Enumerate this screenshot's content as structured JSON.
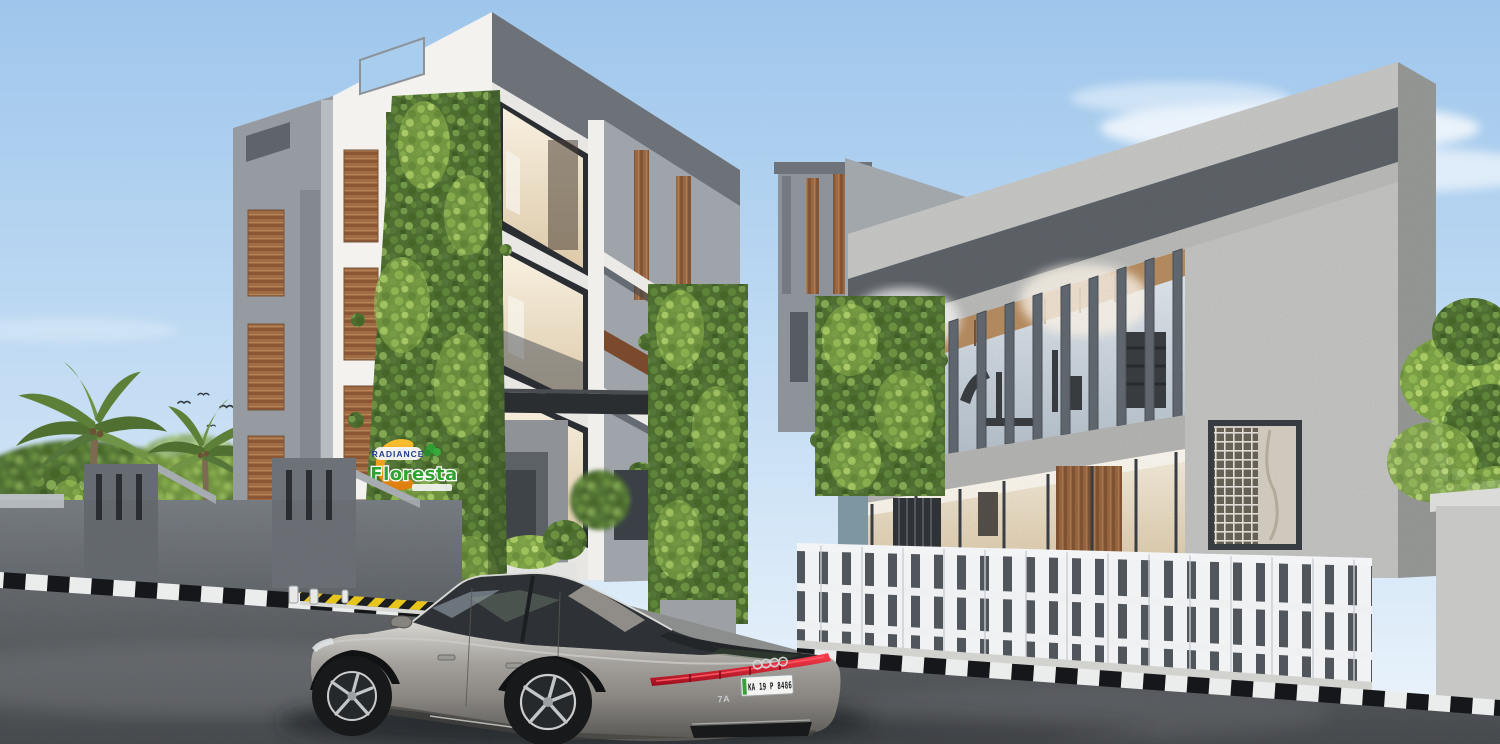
{
  "meta": {
    "title": "Radiance Floresta - exterior architectural render"
  },
  "logo": {
    "brand": "RADIANCE",
    "name": "Floresta"
  },
  "car": {
    "plate": "KA 19 P 8486",
    "badge": "7A"
  },
  "palette": {
    "sky_top": "#9ec6ec",
    "sky_horizon": "#eef5fc",
    "building_white": "#f3f2ee",
    "building_gray": "#878d93",
    "fascia_dark": "#6c7177",
    "wood_brown": "#9a6843",
    "foliage_dark": "#4d6e30",
    "foliage_light": "#8db457",
    "logo_orange": "#f2a31d",
    "logo_green": "#2fa32f",
    "logo_blue": "#23418f",
    "fence_white": "#f0f1f3",
    "road_gray": "#5e6267",
    "taillight_red": "#d40f24",
    "car_gray": "#8b8884",
    "hazard_yellow": "#e9c71f",
    "sign_orange": "#d2691e"
  }
}
